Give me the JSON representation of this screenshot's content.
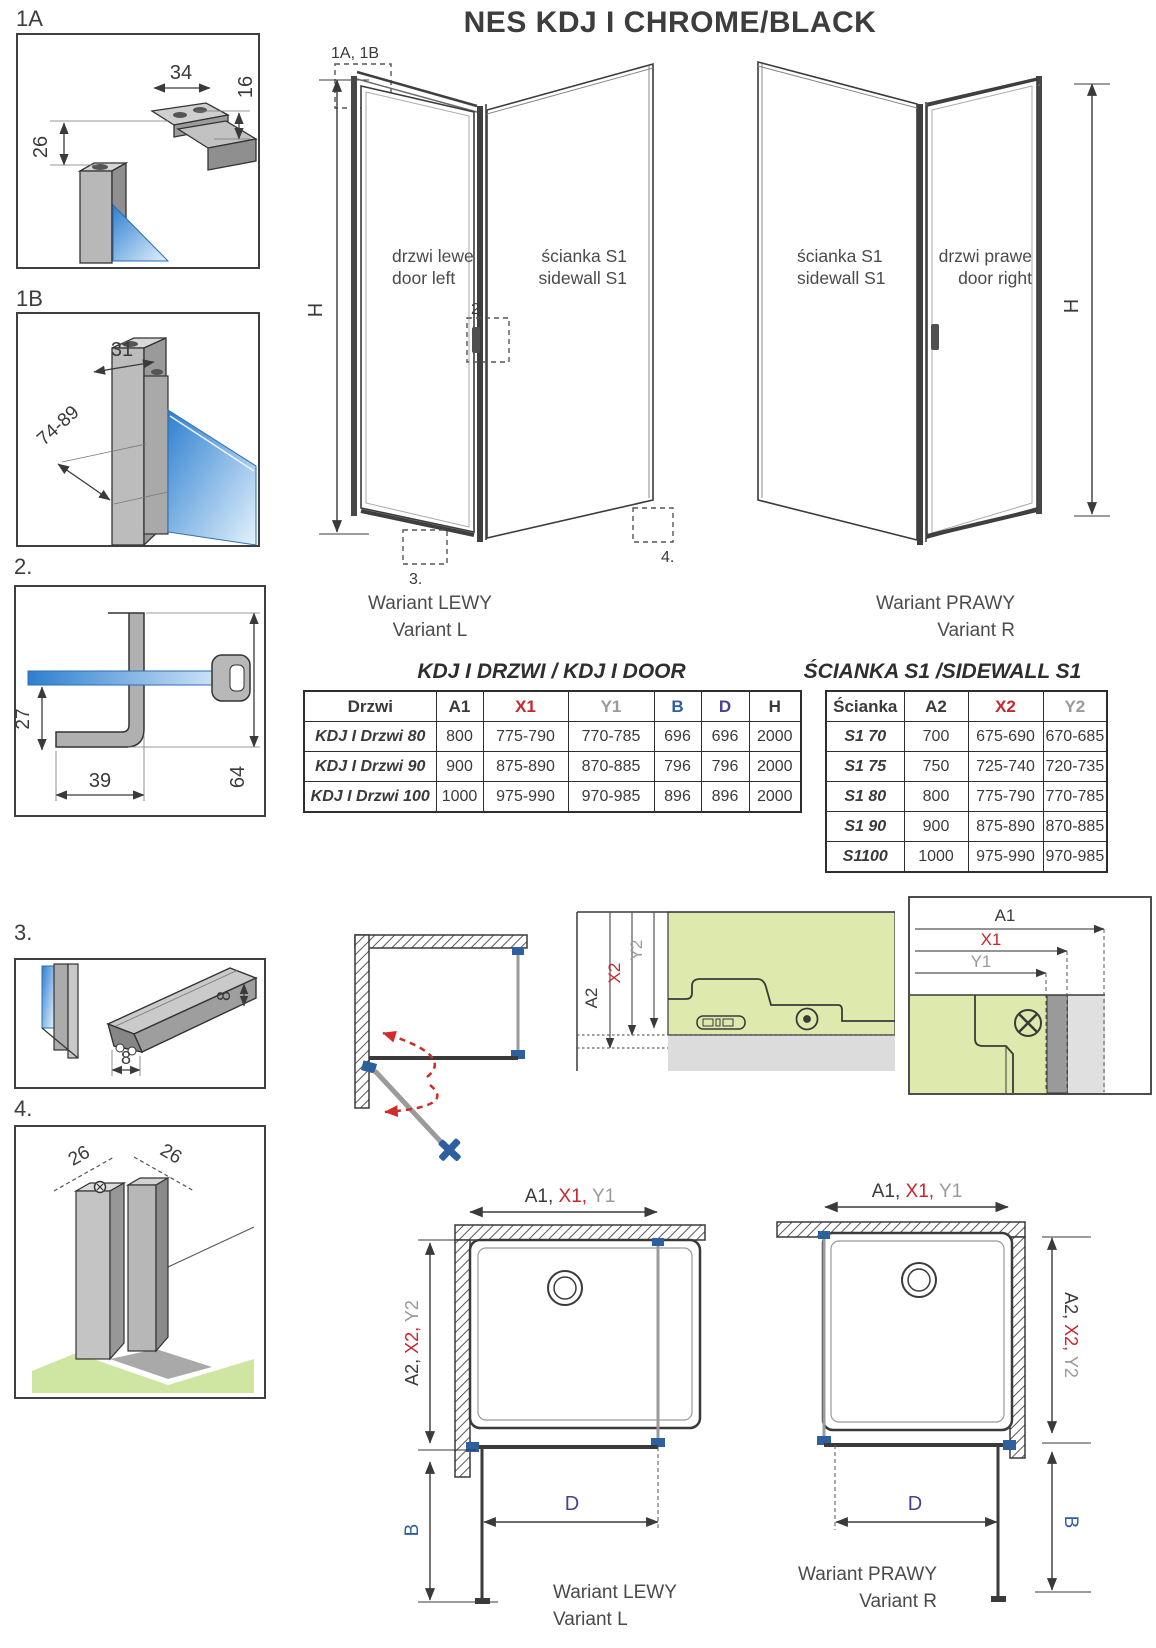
{
  "title": "NES KDJ I CHROME/BLACK",
  "colors": {
    "red": "#c9252c",
    "gray": "#9a9a9a",
    "blue": "#2d5f9e",
    "navy": "#4a4191",
    "glass_blue": "#2e7fd0",
    "glass_green": "#dde9ad",
    "floor_green": "#cfe6a2",
    "hardware_blue": "#2e5f9e"
  },
  "details": {
    "d1a": {
      "label": "1A",
      "dim_width": "34",
      "dim_offset": "16",
      "dim_drop": "26"
    },
    "d1b": {
      "label": "1B",
      "dim_width": "31",
      "dim_range": "74-89"
    },
    "d2": {
      "label": "2.",
      "dim_depth": "27",
      "dim_width": "39",
      "dim_height": "64"
    },
    "d3": {
      "label": "3.",
      "dim_height": "8",
      "dim_width": "8"
    },
    "d4": {
      "label": "4.",
      "dim_left": "26",
      "dim_right": "26"
    }
  },
  "iso_left": {
    "callout": "1A, 1B",
    "door_line1": "drzwi lewe",
    "door_line2": "door left",
    "wall_line1": "ścianka S1",
    "wall_line2": "sidewall S1",
    "height_label": "H",
    "marker_2": "2.",
    "marker_3": "3.",
    "marker_4": "4.",
    "caption_line1": "Wariant LEWY",
    "caption_line2": "Variant L"
  },
  "iso_right": {
    "wall_line1": "ścianka S1",
    "wall_line2": "sidewall S1",
    "door_line1": "drzwi prawe",
    "door_line2": "door right",
    "height_label": "H",
    "caption_line1": "Wariant PRAWY",
    "caption_line2": "Variant R"
  },
  "door_table": {
    "title": "KDJ I DRZWI / KDJ I DOOR",
    "headers": [
      "Drzwi",
      "A1",
      "X1",
      "Y1",
      "B",
      "D",
      "H"
    ],
    "rows": [
      {
        "name": "KDJ I Drzwi 80",
        "a1": "800",
        "x1": "775-790",
        "y1": "770-785",
        "b": "696",
        "d": "696",
        "h": "2000"
      },
      {
        "name": "KDJ I Drzwi 90",
        "a1": "900",
        "x1": "875-890",
        "y1": "870-885",
        "b": "796",
        "d": "796",
        "h": "2000"
      },
      {
        "name": "KDJ I Drzwi 100",
        "a1": "1000",
        "x1": "975-990",
        "y1": "970-985",
        "b": "896",
        "d": "896",
        "h": "2000"
      }
    ]
  },
  "sidewall_table": {
    "title": "ŚCIANKA S1 /SIDEWALL S1",
    "headers": [
      "Ścianka",
      "A2",
      "X2",
      "Y2"
    ],
    "rows": [
      {
        "name": "S1 70",
        "a2": "700",
        "x2": "675-690",
        "y2": "670-685"
      },
      {
        "name": "S1 75",
        "a2": "750",
        "x2": "725-740",
        "y2": "720-735"
      },
      {
        "name": "S1 80",
        "a2": "800",
        "x2": "775-790",
        "y2": "770-785"
      },
      {
        "name": "S1 90",
        "a2": "900",
        "x2": "875-890",
        "y2": "870-885"
      },
      {
        "name": "S1100",
        "a2": "1000",
        "x2": "975-990",
        "y2": "970-985"
      }
    ]
  },
  "mount_sidewall": {
    "a2": "A2",
    "x2": "X2",
    "y2": "Y2"
  },
  "mount_door": {
    "a1": "A1",
    "x1": "X1",
    "y1": "Y1"
  },
  "plan_left": {
    "top_a1": "A1, ",
    "top_x1": "X1, ",
    "top_y1": "Y1",
    "side_a2": "A2, ",
    "side_x2": "X2, ",
    "side_y2": "Y2",
    "b": "B",
    "d": "D",
    "caption_line1": "Wariant LEWY",
    "caption_line2": "Variant L"
  },
  "plan_right": {
    "top_a1": "A1, ",
    "top_x1": "X1, ",
    "top_y1": "Y1",
    "side_a2": "A2, ",
    "side_x2": "X2, ",
    "side_y2": "Y2",
    "b": "B",
    "d": "D",
    "caption_line1": "Wariant PRAWY",
    "caption_line2": "Variant R"
  }
}
